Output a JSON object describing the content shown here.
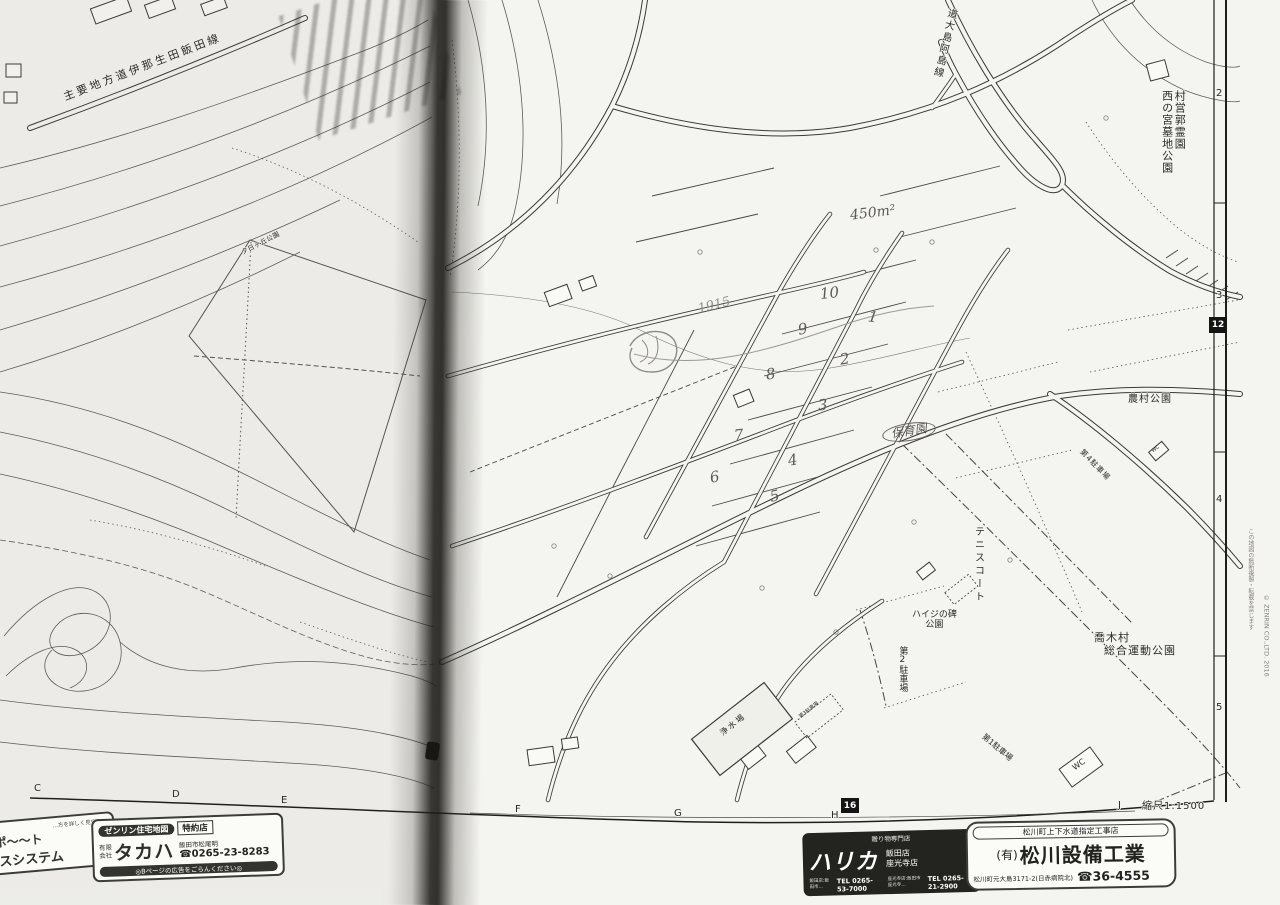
{
  "map": {
    "road_labels": {
      "main_road": "主要地方道伊那生田飯田線",
      "oshima_ajima_line": "道大島阿島線"
    },
    "place_labels": {
      "cemetery_name": "村営郭霊園",
      "cemetery_park": "西の宮墓地公園",
      "yuhigaoka_park": "夕日ヶ丘公園",
      "nouson_park": "農村公園",
      "tennis_court": "テニスコート",
      "heidi_monument_line1": "ハイジの碑",
      "heidi_monument_line2": "公園",
      "village_name": "喬木村",
      "sports_park": "総合運動公園",
      "parking_1": "第1駐車場",
      "parking_2": "第2駐車場",
      "parking_3": "第3駐車場",
      "parking_4": "第4駐車場",
      "water_plant": "浄水場",
      "wc_large": "WC",
      "wc_small": "WC"
    },
    "handwritten": {
      "area_note": "450m²",
      "year_note": "1915",
      "nursery": "保育園",
      "lots_left": [
        "10",
        "9",
        "8",
        "7",
        "6"
      ],
      "lots_right": [
        "1",
        "2",
        "3",
        "4",
        "5"
      ]
    },
    "frame": {
      "bottom_letters": [
        "C",
        "D",
        "E",
        "F",
        "G",
        "H",
        "J"
      ],
      "right_numbers": [
        "2",
        "3",
        "4",
        "5"
      ],
      "page_badge_bottom": "16",
      "page_badge_right": "12",
      "scale": "縮尺1:1500",
      "copyright_jp": "この地図の無断複製・転載を禁じます",
      "copyright_en": "© ZENRIN CO.,LTD. 2016"
    }
  },
  "ads": {
    "left_partial": {
      "line1": "…方を詳しく見守り…",
      "line2": "きりサポ〜〜ト",
      "line3": "サービスシステム"
    },
    "takaha": {
      "badge": "ゼンリン住宅地図",
      "badge2": "特約店",
      "company_prefix": "有限会社",
      "company": "タカハ",
      "address": "飯田市松尾明",
      "phone": "☎0265-23-8283",
      "footer": "◎Bページの広告をごらんください◎"
    },
    "harika": {
      "tagline": "贈り物専門店",
      "brand": "ハリカ",
      "store1": "飯田店",
      "store2": "座光寺店",
      "address1": "飯田店:飯田市…",
      "phone1": "TEL 0265-53-7000",
      "address2": "座光寺店:飯田市座光寺…",
      "phone2": "TEL 0265-21-2900"
    },
    "matsukawa": {
      "header": "松川町上下水道指定工事店",
      "company_prefix": "(有)",
      "company": "松川設備工業",
      "address": "松川町元大島3171-2(日赤病院北)",
      "phone": "☎36-4555"
    }
  }
}
